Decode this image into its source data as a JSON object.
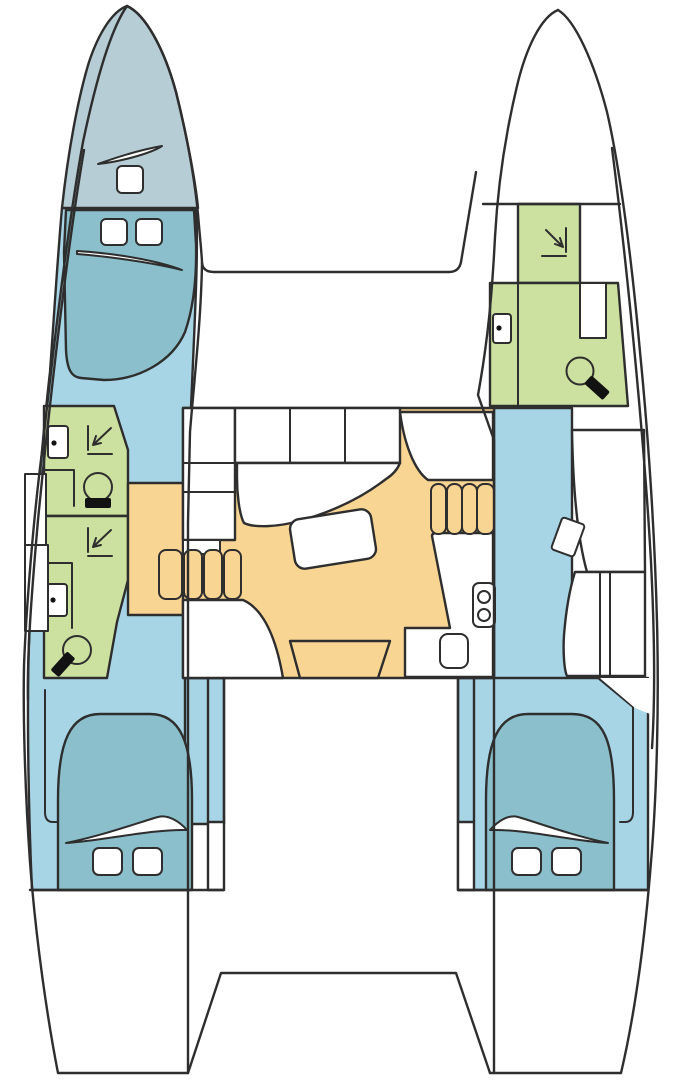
{
  "title": "Catamaran yacht floor plan",
  "diagram_type": "boat-layout-top-view",
  "colors": {
    "outline": "#2e2e2e",
    "hull_white": "#ffffff",
    "forepeak": "#b6cdd5",
    "berth": "#8abfcb",
    "cabin_floor": "#a8d5e6",
    "bathroom": "#cce1a0",
    "saloon": "#f8d593",
    "fixture_black": "#121212"
  },
  "regions": [
    {
      "id": "port-forepeak",
      "color_key": "forepeak"
    },
    {
      "id": "port-forward-berth",
      "color_key": "berth"
    },
    {
      "id": "port-forward-bathroom",
      "color_key": "bathroom"
    },
    {
      "id": "port-aft-bathroom",
      "color_key": "bathroom"
    },
    {
      "id": "port-hull-floor",
      "color_key": "cabin_floor"
    },
    {
      "id": "port-companionway-steps",
      "color_key": "saloon"
    },
    {
      "id": "port-aft-berth",
      "color_key": "berth"
    },
    {
      "id": "starboard-bathroom",
      "color_key": "bathroom"
    },
    {
      "id": "starboard-hull-floor",
      "color_key": "cabin_floor"
    },
    {
      "id": "starboard-companionway-steps",
      "color_key": "saloon"
    },
    {
      "id": "starboard-aft-berth",
      "color_key": "berth"
    },
    {
      "id": "saloon-floor",
      "color_key": "saloon"
    },
    {
      "id": "cockpit-door",
      "color_key": "saloon"
    }
  ],
  "fixtures": [
    "toilet",
    "washbasin",
    "shower-drain-arrow",
    "stove-burners",
    "galley-sink",
    "saloon-table",
    "sofa",
    "galley-counter",
    "nav-desk",
    "stool",
    "wardrobe",
    "deck-hatch",
    "pillow",
    "hull-window",
    "stairs",
    "foredeck",
    "transom-platform"
  ]
}
